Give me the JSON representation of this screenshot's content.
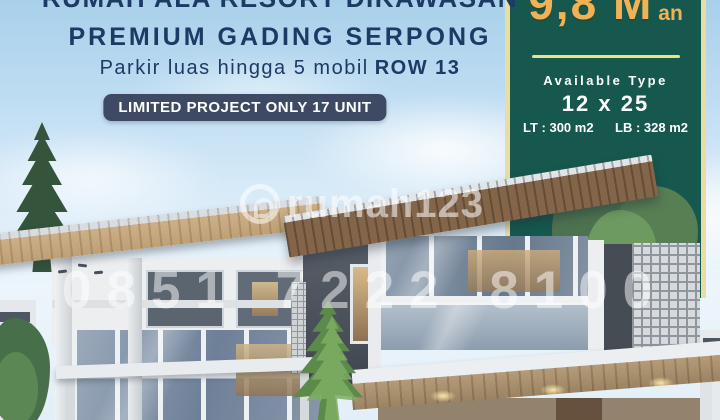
{
  "headline": {
    "line1": "RUMAH ALA RESORT DIKAWASAN",
    "line2": "PREMIUM GADING SERPONG",
    "subtitle": "Parkir luas hingga 5 mobil",
    "subtitle_bold": "ROW 13",
    "badge": "LIMITED PROJECT ONLY 17 UNIT",
    "text_color": "#1c3a64",
    "badge_bg": "#3e4a64"
  },
  "price_panel": {
    "price": "9,8 M",
    "suffix": "an",
    "available_label": "Available Type",
    "type_size": "12 x 25",
    "lt_label": "LT : 300 m2",
    "lb_label": "LB : 328 m2",
    "panel_color": "#16584e",
    "border_color": "#e9dda6",
    "price_color": "#f1b156",
    "divider_color": "#eae285"
  },
  "watermark": {
    "brand": "rumah123",
    "phone": "0851 7222 8100"
  }
}
